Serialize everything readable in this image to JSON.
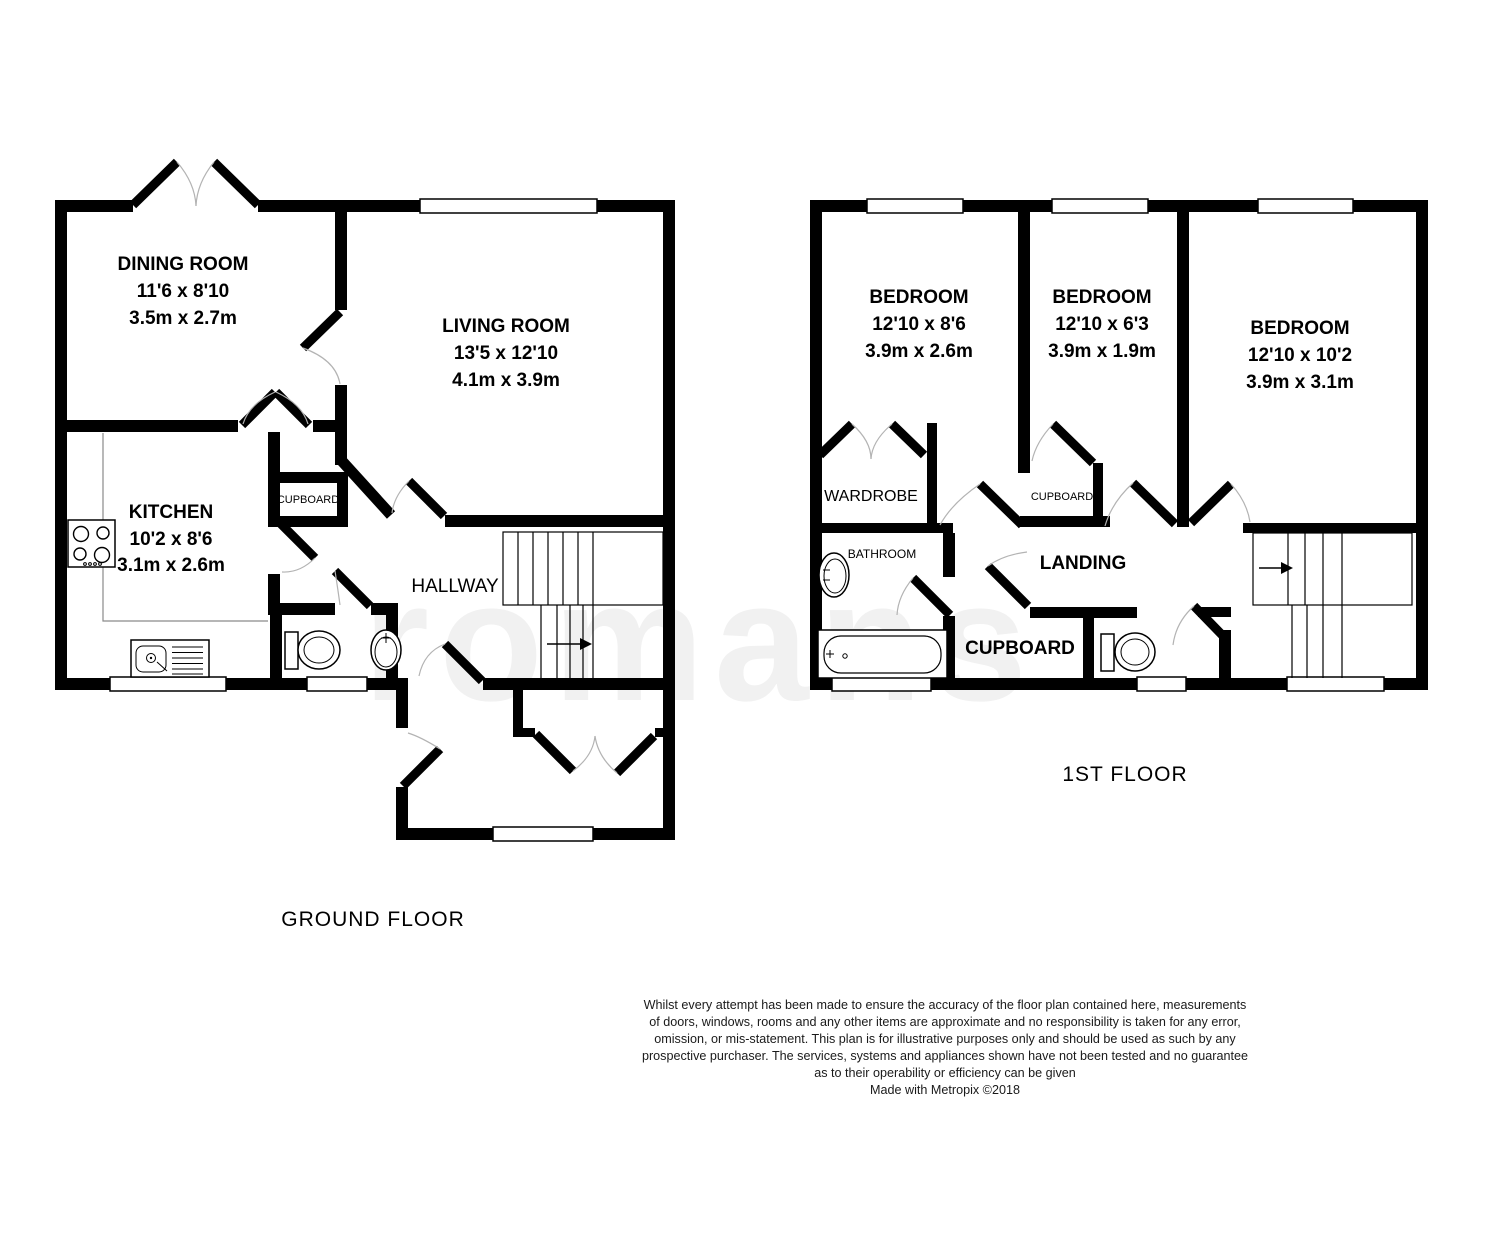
{
  "watermark_text": "romans",
  "colors": {
    "wall": "#000000",
    "window_fill": "#ffffff",
    "door_arc": "#b3b3b3",
    "label_text": "#000000",
    "watermark": "#f1f1f1"
  },
  "ground_floor": {
    "title": "GROUND FLOOR",
    "rooms": {
      "dining": {
        "name": "DINING ROOM",
        "imperial": "11'6 x 8'10",
        "metric": "3.5m x 2.7m"
      },
      "living": {
        "name": "LIVING ROOM",
        "imperial": "13'5 x 12'10",
        "metric": "4.1m x 3.9m"
      },
      "kitchen": {
        "name": "KITCHEN",
        "imperial": "10'2 x 8'6",
        "metric": "3.1m x 2.6m"
      },
      "cupboard": {
        "name": "CUPBOARD"
      },
      "hallway": {
        "name": "HALLWAY"
      }
    }
  },
  "first_floor": {
    "title": "1ST FLOOR",
    "rooms": {
      "bedroom1": {
        "name": "BEDROOM",
        "imperial": "12'10 x 8'6",
        "metric": "3.9m x 2.6m"
      },
      "bedroom2": {
        "name": "BEDROOM",
        "imperial": "12'10 x 6'3",
        "metric": "3.9m x 1.9m"
      },
      "bedroom3": {
        "name": "BEDROOM",
        "imperial": "12'10 x 10'2",
        "metric": "3.9m x 3.1m"
      },
      "wardrobe": {
        "name": "WARDROBE"
      },
      "cupboard_small": {
        "name": "CUPBOARD"
      },
      "bathroom": {
        "name": "BATHROOM"
      },
      "landing": {
        "name": "LANDING"
      },
      "cupboard_large": {
        "name": "CUPBOARD"
      }
    }
  },
  "footer": {
    "disclaimer_lines": [
      "Whilst every attempt has been made to ensure the accuracy of the floor plan contained here, measurements",
      "of doors, windows, rooms and any other items are approximate and no responsibility is taken for any error,",
      "omission, or mis-statement. This plan is for illustrative purposes only and should be used as such by any",
      "prospective purchaser. The services, systems and appliances shown have not been tested and no guarantee",
      "as to their operability or efficiency can be given"
    ],
    "credit": "Made with Metropix ©2018"
  }
}
